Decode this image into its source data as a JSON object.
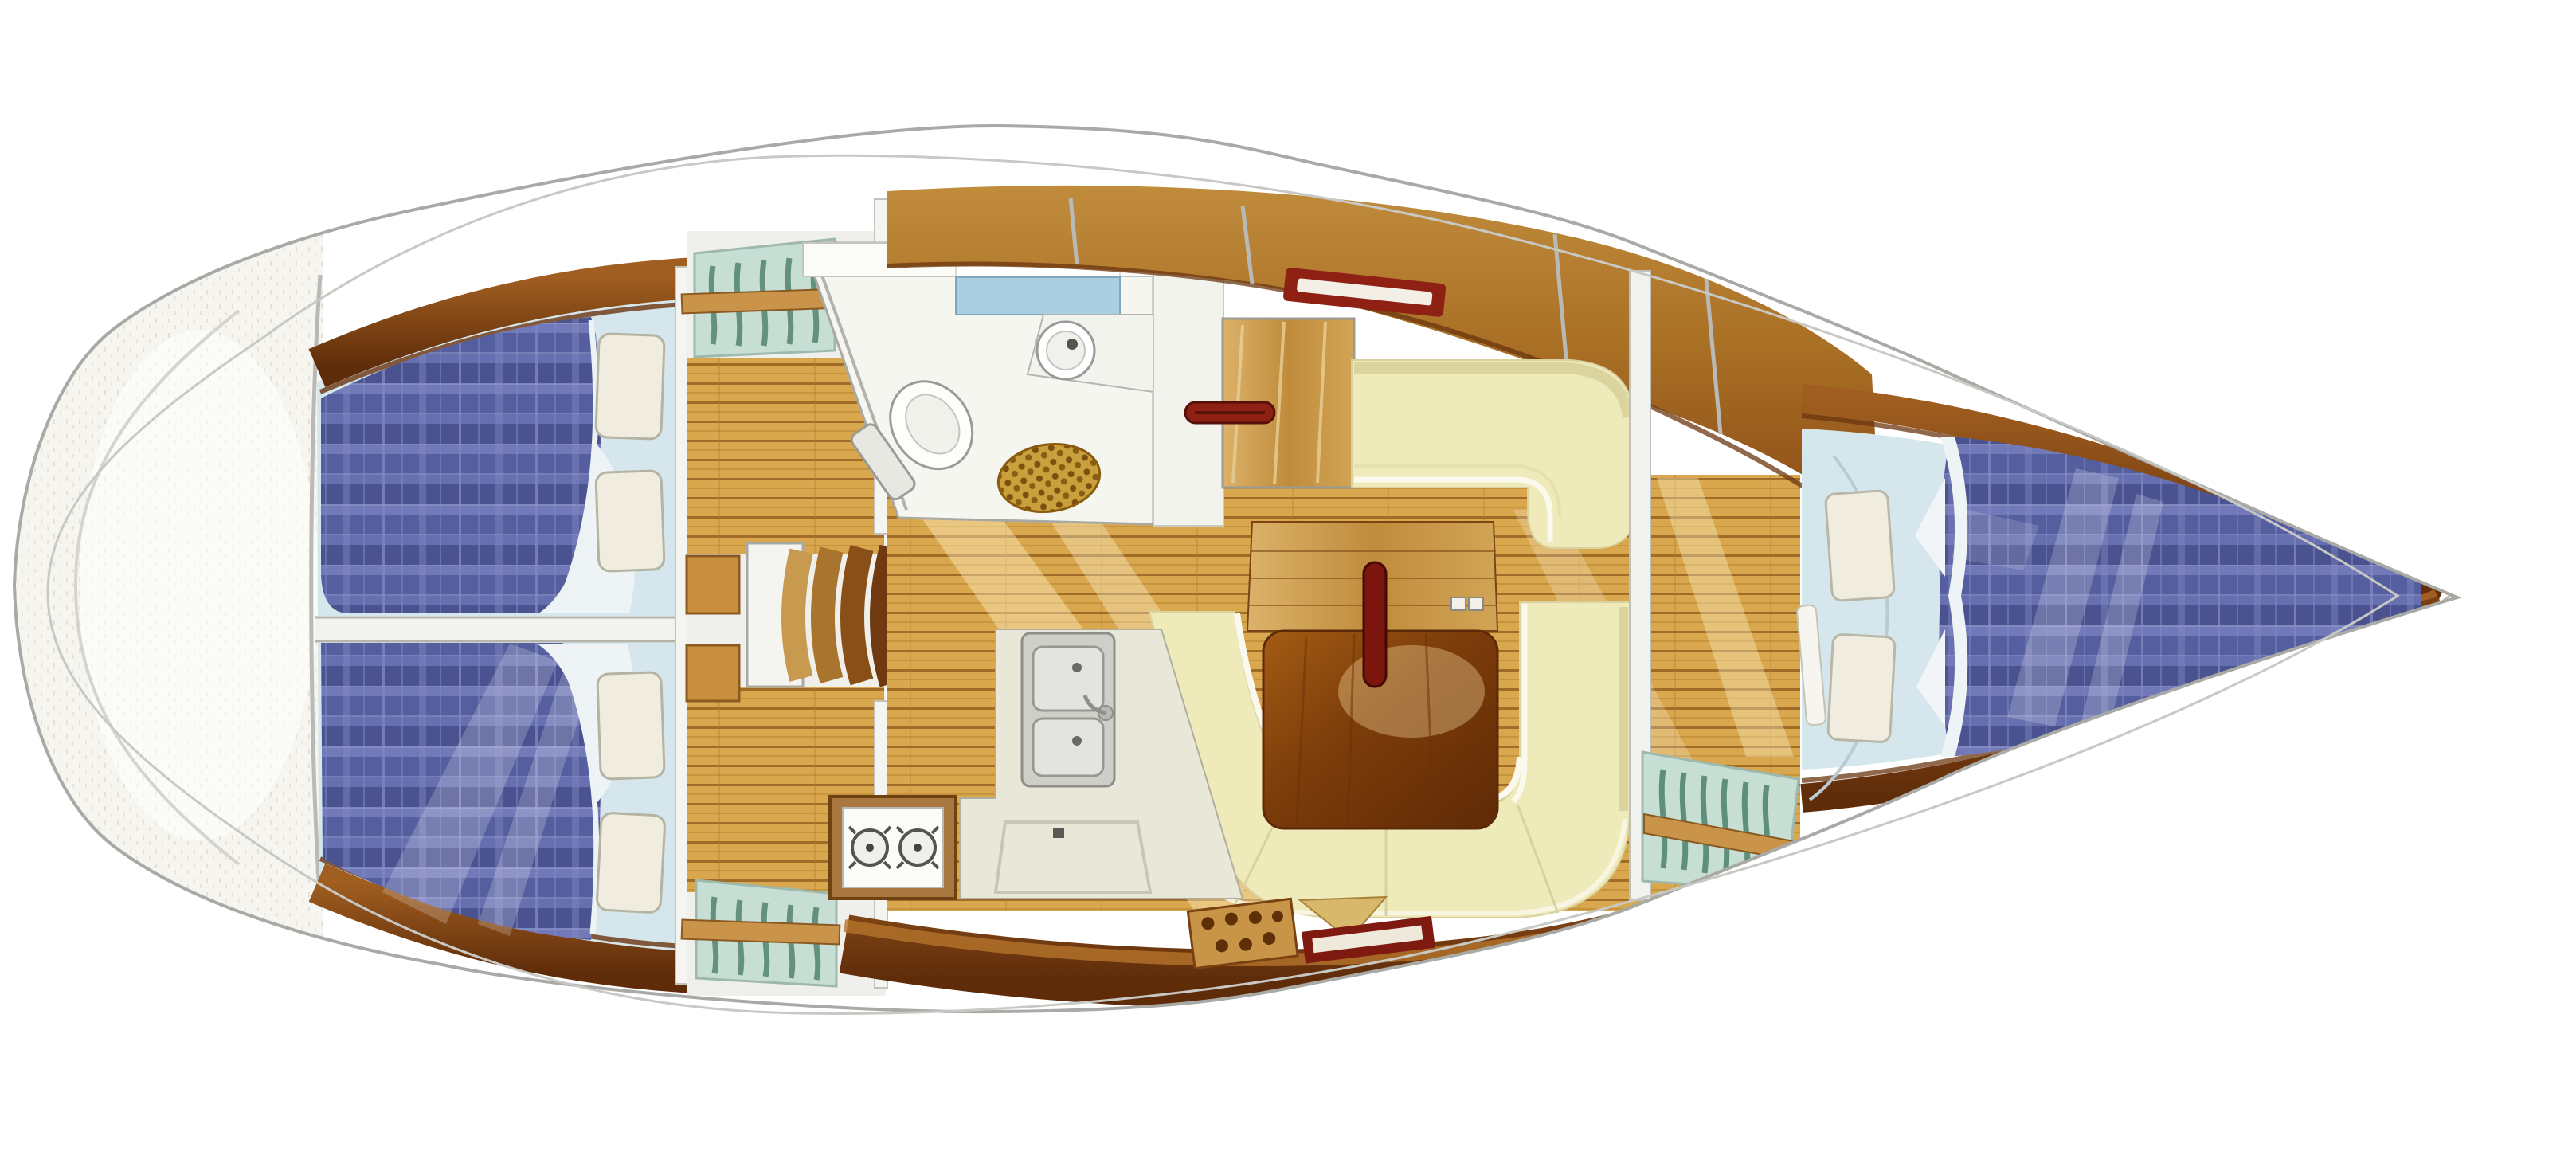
{
  "meta": {
    "type": "boat-interior-floor-plan",
    "view": "top-down",
    "orientation": "bow-right"
  },
  "palette": {
    "page_bg": "#ffffff",
    "hull_fill": "#ffffff",
    "hull_outline": "#a9a9a6",
    "deck_line": "#c8c8c4",
    "stern_fill": "#f6f5f0",
    "berth_surround": "#d5e7ec",
    "mattress_base": "#555e9e",
    "mattress_dark": "#4a5290",
    "mattress_light": "#6d76b4",
    "plaid_line": "#7e86c0",
    "sheet_white": "#eef3f6",
    "pillow_fill": "#f0ecdf",
    "pillow_edge": "#b5b3a2",
    "divider_fill": "#f2f2ee",
    "locker_bg": "#c6ded4",
    "locker_slat": "#63917e",
    "locker_rail": "#c9944a",
    "floor_light": "#d9a84e",
    "floor_seam": "#a06c28",
    "wood_light": "#dcb26a",
    "wood_mid": "#c08c3c",
    "wood_dark": "#8a4a16",
    "wood_edge": "#6b3510",
    "settee_fill": "#efeaba",
    "settee_edge": "#fbf9ee",
    "settee_shadow": "#dcd49e",
    "table_dark": "#5f2a06",
    "mast_red": "#7c150e",
    "accent_red": "#8e2014",
    "head_floor": "#f6f6f1",
    "wall_white": "#f3f3ee",
    "counter_blue": "#aacfe1",
    "fixture_stroke": "#9a9a96",
    "mat_gold": "#c9a03c",
    "mat_dot": "#7c4f0e",
    "galley_counter": "#e9e7d8",
    "sink_gray": "#cfcfca",
    "basin_gray": "#e3e3e0",
    "stove_frame": "#a97840",
    "grate_tan": "#c89448",
    "grate_dot": "#5f3008"
  },
  "regions": [
    "stern-lazarette",
    "aft-cabin-upper-berth",
    "aft-cabin-lower-berth",
    "hanging-locker-aft-top",
    "hanging-locker-aft-bottom",
    "companionway-steps",
    "head-bathroom",
    "saloon",
    "chart-table",
    "saloon-table",
    "mast",
    "galley",
    "hanging-locker-fore",
    "fore-cabin-v-berth",
    "bow"
  ],
  "counts": {
    "aft_berths": 2,
    "aft_pillows": 4,
    "fore_pillows": 2,
    "companionway_steps": 4,
    "stove_burners": 2,
    "sink_basins": 2,
    "locker_panels": 3
  }
}
